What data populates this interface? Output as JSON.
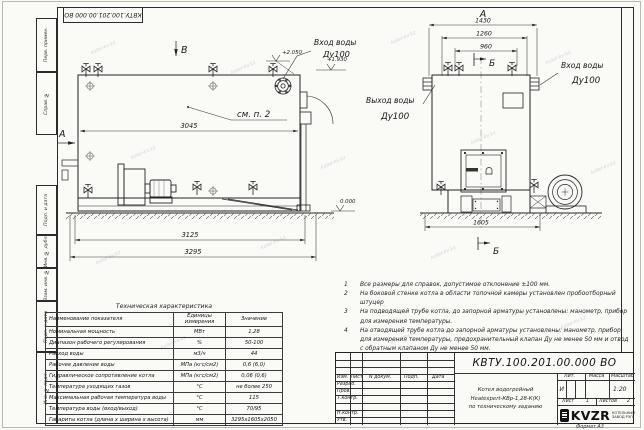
{
  "page": {
    "watermark": "kotel-kv.kz",
    "format_note": "Формат А3"
  },
  "stamp_top": "КВТУ.100.201.00.000 ВО",
  "strip": {
    "items": [
      "Перв. примен.",
      "Справ. №",
      "Подп. и дата",
      "Инв. № дубл.",
      "Взам. инв. №",
      "Подп. и дата",
      "Инв. № подл."
    ]
  },
  "drawing": {
    "left_view": {
      "marker_b": "В",
      "marker_a": "А",
      "see_note": "см. п. 2",
      "dim_3045": "3045",
      "dim_3125": "3125",
      "dim_3295": "3295",
      "elev_top": "+2.050",
      "elev_inlet": "+1.930",
      "elev_zero": "0.000",
      "inlet_line1": "Вход воды",
      "inlet_line2": "Ду100"
    },
    "right_view": {
      "title": "А",
      "section": "Б",
      "dim_1430": "1430",
      "dim_1260": "1260",
      "dim_960": "960",
      "dim_1605": "1605",
      "outlet_line1": "Выход воды",
      "outlet_line2": "Ду100",
      "inlet_line1": "Вход воды",
      "inlet_line2": "Ду100"
    }
  },
  "notes": [
    {
      "num": "1",
      "text": "Все размеры для справок, допустимое отклонение ±100 мм."
    },
    {
      "num": "2",
      "text": "На боковой стенке котла в области топочной камеры установлен пробоотборный штуцер"
    },
    {
      "num": "3",
      "text": "На подводящей трубе котла, до запорной арматуры установлены: манометр, прибор для измерения температуры."
    },
    {
      "num": "4",
      "text": "На отводящей трубе котла до запорной арматуры установлены: манометр, прибор для измерения температуры, предохранительный клапан Ду не менее 50 мм и отвод с обратным клапаном Ду не менее 50 мм."
    }
  ],
  "spec_table": {
    "title": "Техническая характеристика",
    "headers": [
      "Наименование показателя",
      "Единицы измерения",
      "Значение"
    ],
    "rows": [
      {
        "name": "Номинальная мощность",
        "unit": "МВт",
        "value": "1,28"
      },
      {
        "name": "Диапазон рабочего регулирования",
        "unit": "%",
        "value": "50-100"
      },
      {
        "name": "Расход воды",
        "unit": "м3/ч",
        "value": "44"
      },
      {
        "name": "Рабочее давление воды",
        "unit": "МПа (кгс/см2)",
        "value": "0,6 (6,0)"
      },
      {
        "name": "Гидравлическое сопротивление котла",
        "unit": "МПа (кгс/см2)",
        "value": "0,06 (0,6)"
      },
      {
        "name": "Температура уходящих газов",
        "unit": "°С",
        "value": "не более 250"
      },
      {
        "name": "Максимальная рабочая температура воды",
        "unit": "°С",
        "value": "115"
      },
      {
        "name": "Температура воды (вход/выход)",
        "unit": "°С",
        "value": "70/95"
      },
      {
        "name": "Габариты котла (длина х ширина х высота)",
        "unit": "мм",
        "value": "3295х1605х2050"
      }
    ]
  },
  "title_block": {
    "doc_number": "КВТУ.100.201.00.000  ВО",
    "product_line1": "Котел водогрейный",
    "product_line2": "Heatexpert-КВр-1,28-К(К)",
    "product_line3": "по техническому заданию",
    "col_izm": "Изм.",
    "col_list": "Лист",
    "col_doc": "N докум.",
    "col_sign": "Подп.",
    "col_date": "Дата",
    "row_razrab": "Разраб.",
    "row_prov": "Пров.",
    "row_tkontr": "Т.контр.",
    "row_nkontr": "Н.контр.",
    "row_utv": "Утв.",
    "lit_header": "Лит.",
    "mass_header": "Масса",
    "scale_header": "Масштаб",
    "lit_value": "И",
    "scale_value": "1:20",
    "sheet_label": "Лист",
    "sheet_value": "1",
    "sheets_label": "Листов",
    "sheets_value": "2",
    "logo_word": "KVZR",
    "logo_sub1": "КОТЕЛЬНЫЙ",
    "logo_sub2": "ЗАВОД РЭП"
  }
}
